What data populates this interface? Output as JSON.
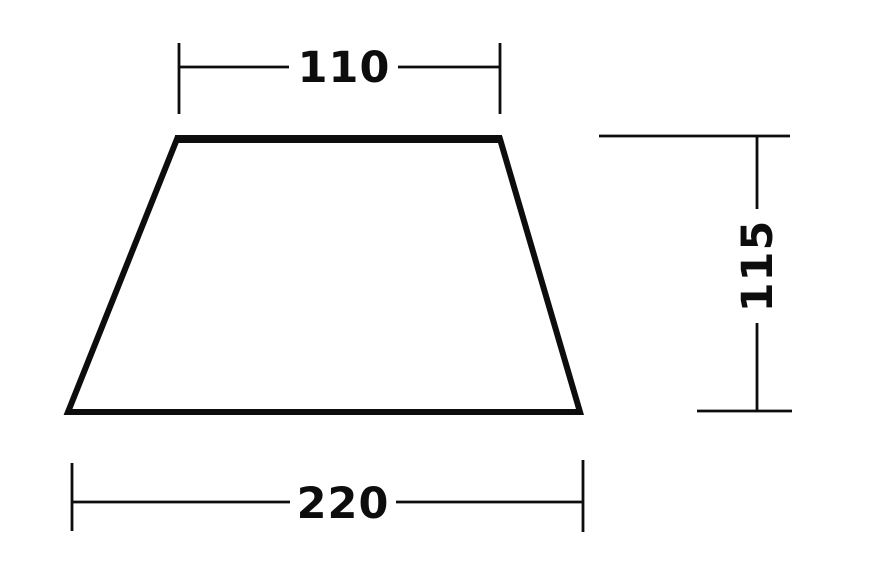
{
  "diagram": {
    "shape": "trapezoid",
    "background_color": "#ffffff",
    "line_color": "#0d0d0d",
    "labels": {
      "top_width": "110",
      "bottom_width": "220",
      "height": "115"
    },
    "dimensions": {
      "top_width": 110,
      "bottom_width": 220,
      "height": 115
    }
  }
}
